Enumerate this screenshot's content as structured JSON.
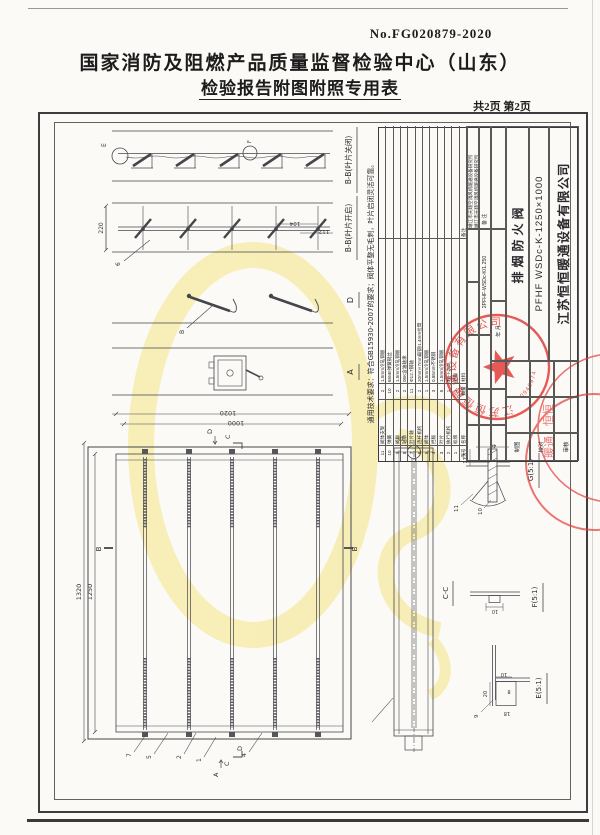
{
  "page": {
    "report_no": "No.FG020879-2020",
    "title_line1": "国家消防及阻燃产品质量监督检验中心（山东）",
    "title_line2": "检验报告附图附照专用表",
    "page_info": "共2页 第2页"
  },
  "drawing": {
    "general_note": "通用技术要求：符合GB15930-2007的要求；阀体平整无毛刺，叶片启闭灵活可靠。",
    "views": {
      "v1": "B-B(叶片关闭)",
      "v2": "B-B(叶片开启)",
      "d": "D",
      "a": "A",
      "cc": "C-C",
      "g": "G(5:1)",
      "f": "F(5:1)",
      "e": "E(5:1)"
    },
    "dims": {
      "outer_w": "1020",
      "inner_w": "1000",
      "outer_h": "1320",
      "inner_h": "1250",
      "open_height": "220",
      "pitch1": "104",
      "pitch2": "112",
      "g1": "17.5",
      "g2": "40",
      "f1": "10",
      "e1": "10",
      "e2": "8",
      "e3": "20",
      "e4": "18"
    },
    "callouts": {
      "n1": "1",
      "n2": "2",
      "n4": "4",
      "n5": "5",
      "n6": "6",
      "n7": "7",
      "n9": "9",
      "n10": "10",
      "n11": "11",
      "b": "B",
      "e": "E",
      "f": "F",
      "g": "G",
      "a_mark": "A",
      "c_mark": "C",
      "d_mark": "D",
      "b_left": "B",
      "b_right": "B",
      "c_top": "C",
      "d_top": "D"
    }
  },
  "bom": {
    "headers": {
      "no": "序号",
      "name": "名称",
      "qty": "数量",
      "material": "材料",
      "remark": "备注"
    },
    "rows": [
      {
        "no": "11",
        "name": "阀体支架",
        "qty": "2",
        "mat": "1.5mm冷轧钢板",
        "rem": ""
      },
      {
        "no": "10",
        "name": "弹簧",
        "qty": "10",
        "mat": "65Mn弹簧钢丝",
        "rem": ""
      },
      {
        "no": "9",
        "name": "阀板",
        "qty": "2",
        "mat": "1.5mm冷轧钢板",
        "rem": ""
      },
      {
        "no": "8",
        "name": "轴承",
        "qty": "2",
        "mat": "05K含油轴承",
        "rem": ""
      },
      {
        "no": "7",
        "name": "叶片轴",
        "qty": "11",
        "mat": "Φ12.7钢轴",
        "rem": ""
      },
      {
        "no": "6",
        "name": "连杆机构",
        "qty": "2",
        "mat": "20mm×7mm扁钢/1.4mm拉臂",
        "rem": ""
      },
      {
        "no": "5",
        "name": "阀体",
        "qty": "1",
        "mat": "1.5mm冷轧钢板",
        "rem": ""
      },
      {
        "no": "4",
        "name": "挡板",
        "qty": "3",
        "mat": "0.85mm不锈钢",
        "rem": ""
      },
      {
        "no": "3",
        "name": "叶片",
        "qty": "5",
        "mat": "1.5mm冷轧钢板",
        "rem": ""
      },
      {
        "no": "2",
        "name": "执行机构",
        "qty": "1",
        "mat": "TD-I-280",
        "rem": ""
      },
      {
        "no": "1",
        "name": "标牌",
        "qty": "1",
        "mat": "铝板",
        "rem": ""
      }
    ]
  },
  "title_block": {
    "institute_line1": "靖江市天翔空调风机暖通设备研究所",
    "institute_line2": "靖江市天翔空调风机暖通设备研究所",
    "remark_label": "备 注",
    "drawing_no": "2PFHF-WSDc-K/1.250",
    "date_label": "年  月",
    "draft_label": "制图",
    "check_label": "校对",
    "approve_label": "审核",
    "product_name": "排烟防火阀",
    "spec": "PFHF WSDc-K-1250×1000",
    "company": "江苏恒恒暖通设备有限公司"
  },
  "stamps": {
    "main": {
      "company": "江苏恒恒暖通设备有限公司",
      "serial": "0946974"
    },
    "secondary": {
      "text1": "恒恒",
      "text2": "暖通"
    }
  },
  "colors": {
    "accent_red": "#e23d3c",
    "watermark_yellow": "#f4e27a",
    "line": "#4a4a52"
  }
}
